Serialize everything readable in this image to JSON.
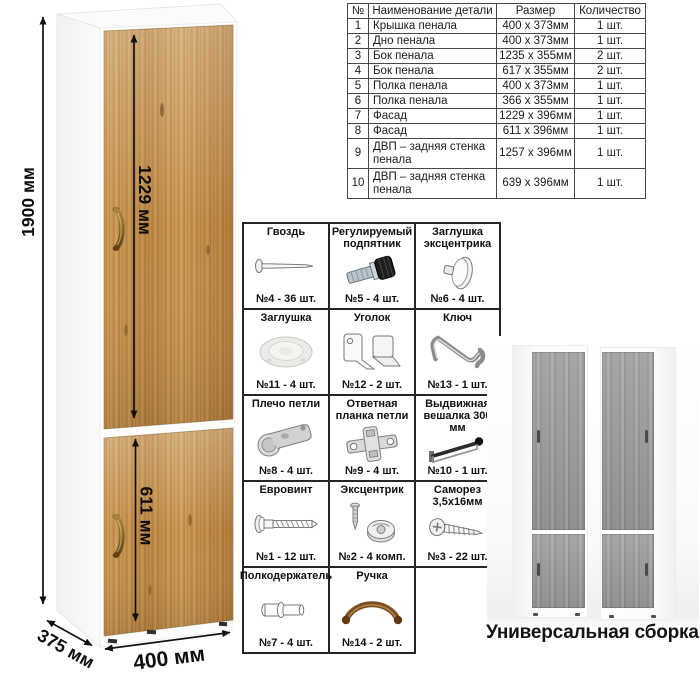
{
  "cabinet_diagram": {
    "dims": {
      "height": "1900 мм",
      "upper_door": "1229 мм",
      "lower_door": "611 мм",
      "depth": "375 мм",
      "width": "400 мм"
    }
  },
  "parts_table": {
    "headers": {
      "num": "№",
      "name": "Наименование детали",
      "size": "Размер",
      "qty": "Количество"
    },
    "rows": [
      {
        "num": "1",
        "name": "Крышка пенала",
        "size": "400 х 373мм",
        "qty": "1 шт."
      },
      {
        "num": "2",
        "name": "Дно пенала",
        "size": "400 х 373мм",
        "qty": "1 шт."
      },
      {
        "num": "3",
        "name": "Бок пенала",
        "size": "1235 х 355мм",
        "qty": "2 шт."
      },
      {
        "num": "4",
        "name": "Бок пенала",
        "size": "617 х 355мм",
        "qty": "2 шт."
      },
      {
        "num": "5",
        "name": "Полка пенала",
        "size": "400 х 373мм",
        "qty": "1 шт."
      },
      {
        "num": "6",
        "name": "Полка пенала",
        "size": "366 х 355мм",
        "qty": "1 шт."
      },
      {
        "num": "7",
        "name": "Фасад",
        "size": "1229 х 396мм",
        "qty": "1 шт."
      },
      {
        "num": "8",
        "name": "Фасад",
        "size": "611 х 396мм",
        "qty": "1 шт."
      },
      {
        "num": "9",
        "name": "ДВП – задняя стенка пенала",
        "size": "1257 х 396мм",
        "qty": "1 шт."
      },
      {
        "num": "10",
        "name": "ДВП – задняя стенка пенала",
        "size": "639 х 396мм",
        "qty": "1 шт."
      }
    ]
  },
  "hardware_grid": {
    "items": [
      {
        "title": "Гвоздь",
        "count": "№4 - 36 шт.",
        "icon": "nail-icon"
      },
      {
        "title": "Регулируемый подпятник",
        "count": "№5 - 4 шт.",
        "icon": "adjustable-foot-icon"
      },
      {
        "title": "Заглушка эксцентрика",
        "count": "№6 - 4 шт.",
        "icon": "cam-cover-icon"
      },
      {
        "title": "Заглушка",
        "count": "№11 - 4 шт.",
        "icon": "cap-icon"
      },
      {
        "title": "Уголок",
        "count": "№12 - 2 шт.",
        "icon": "corner-bracket-icon"
      },
      {
        "title": "Ключ",
        "count": "№13 - 1 шт.",
        "icon": "hex-key-icon"
      },
      {
        "title": "Плечо петли",
        "count": "№8 - 4 шт.",
        "icon": "hinge-arm-icon"
      },
      {
        "title": "Ответная планка петли",
        "count": "№9 - 4 шт.",
        "icon": "hinge-plate-icon"
      },
      {
        "title": "Выдвижная вешалка 300 мм",
        "count": "№10 - 1 шт.",
        "icon": "pullout-hanger-icon"
      },
      {
        "title": "Евровинт",
        "count": "№1 - 12 шт.",
        "icon": "euro-screw-icon"
      },
      {
        "title": "Эксцентрик",
        "count": "№2 - 4 комп.",
        "icon": "cam-lock-icon"
      },
      {
        "title": "Саморез 3,5х16мм",
        "count": "№3 - 22 шт.",
        "icon": "self-tapping-screw-icon"
      },
      {
        "title": "Полкодержатель",
        "count": "№7 - 4 шт.",
        "icon": "shelf-pin-icon"
      },
      {
        "title": "Ручка",
        "count": "№14 - 2 шт.",
        "icon": "handle-icon"
      }
    ]
  },
  "assembly_note": {
    "caption": "Универсальная сборка."
  },
  "colors": {
    "wood": "#c28d49",
    "wood_dark": "#9c6c2f",
    "gray_wood": "#999999",
    "bronze": "#7d5126",
    "dimension": "#111111"
  }
}
